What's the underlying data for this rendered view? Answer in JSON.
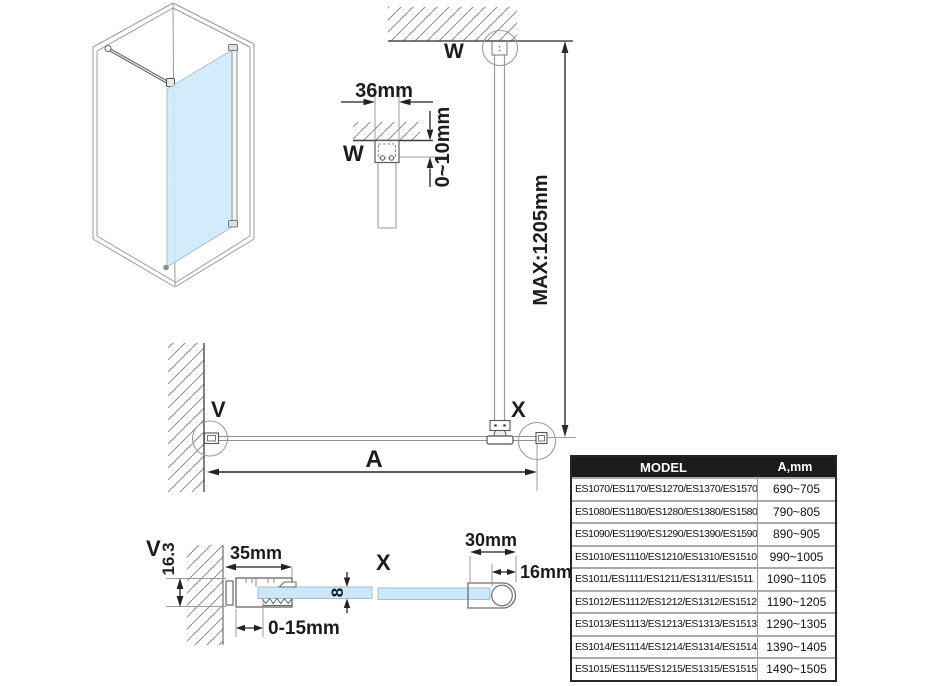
{
  "drawing": {
    "view_labels": {
      "ceiling_detail": "W",
      "ceiling_anchor": "W",
      "wall_anchor": "V",
      "end_anchor": "X",
      "wall_detail": "V",
      "end_detail": "X",
      "width_dim": "A"
    },
    "dimensions": {
      "bracket_width": "36mm",
      "ceiling_gap": "0~10mm",
      "max_bar_height": "MAX:1205mm",
      "wall_profile_width": "35mm",
      "wall_profile_height": "16.3",
      "wall_adjust_range": "0-15mm",
      "glass_thickness": "8",
      "end_profile_width": "30mm",
      "end_profile_depth": "16mm"
    },
    "colors": {
      "glass": "#cbe9fa",
      "construction_line": "#9b9b9b",
      "dimension_line": "#1c1c1c"
    }
  },
  "table": {
    "headers": [
      "MODEL",
      "A,mm"
    ],
    "header_bg": "#1b1b1b",
    "rows": [
      {
        "model": "ES1070/ES1170/ES1270/ES1370/ES1570",
        "a": "690~705"
      },
      {
        "model": "ES1080/ES1180/ES1280/ES1380/ES1580",
        "a": "790~805"
      },
      {
        "model": "ES1090/ES1190/ES1290/ES1390/ES1590",
        "a": "890~905"
      },
      {
        "model": "ES1010/ES1110/ES1210/ES1310/ES1510",
        "a": "990~1005"
      },
      {
        "model": "ES1011/ES1111/ES1211/ES1311/ES1511",
        "a": "1090~1105"
      },
      {
        "model": "ES1012/ES1112/ES1212/ES1312/ES1512",
        "a": "1190~1205"
      },
      {
        "model": "ES1013/ES1113/ES1213/ES1313/ES1513",
        "a": "1290~1305"
      },
      {
        "model": "ES1014/ES1114/ES1214/ES1314/ES1514",
        "a": "1390~1405"
      },
      {
        "model": "ES1015/ES1115/ES1215/ES1315/ES1515",
        "a": "1490~1505"
      }
    ]
  }
}
